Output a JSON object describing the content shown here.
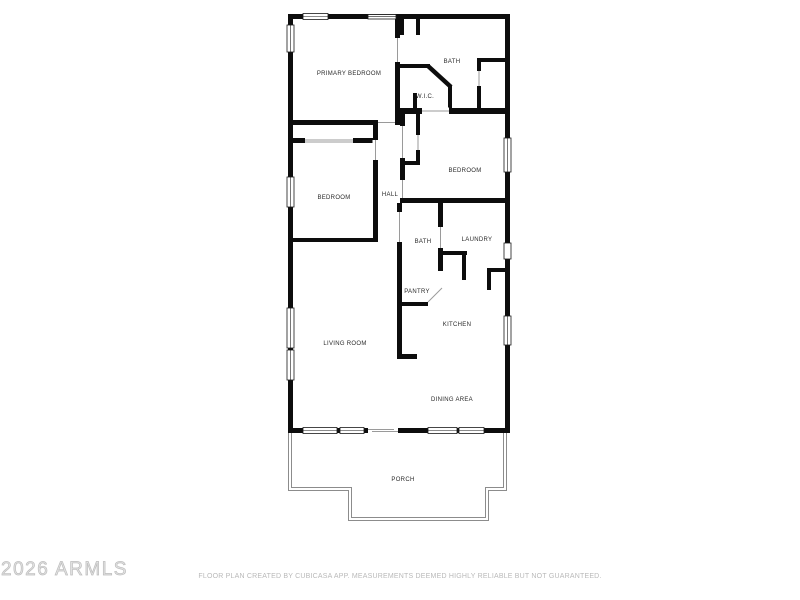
{
  "page": {
    "background": "#ffffff"
  },
  "watermark": {
    "text": "2026 ARMLS",
    "color": "#c4c4c4"
  },
  "footer": {
    "disclaimer": "FLOOR PLAN CREATED BY CUBICASA APP. MEASUREMENTS DEEMED HIGHLY RELIABLE BUT NOT GUARANTEED.",
    "color": "#b9b9b9"
  },
  "floor_plan": {
    "wall_color": "#0d0d0d",
    "porch_line_color": "#8c8c8c",
    "label_color": "#2a2a2a",
    "rooms": [
      {
        "label": "PRIMARY BEDROOM"
      },
      {
        "label": "BATH"
      },
      {
        "label": "W.I.C."
      },
      {
        "label": "BEDROOM"
      },
      {
        "label": "HALL"
      },
      {
        "label": "BEDROOM"
      },
      {
        "label": "BATH"
      },
      {
        "label": "LAUNDRY"
      },
      {
        "label": "PANTRY"
      },
      {
        "label": "KITCHEN"
      },
      {
        "label": "LIVING ROOM"
      },
      {
        "label": "DINING AREA"
      },
      {
        "label": "PORCH"
      }
    ]
  }
}
